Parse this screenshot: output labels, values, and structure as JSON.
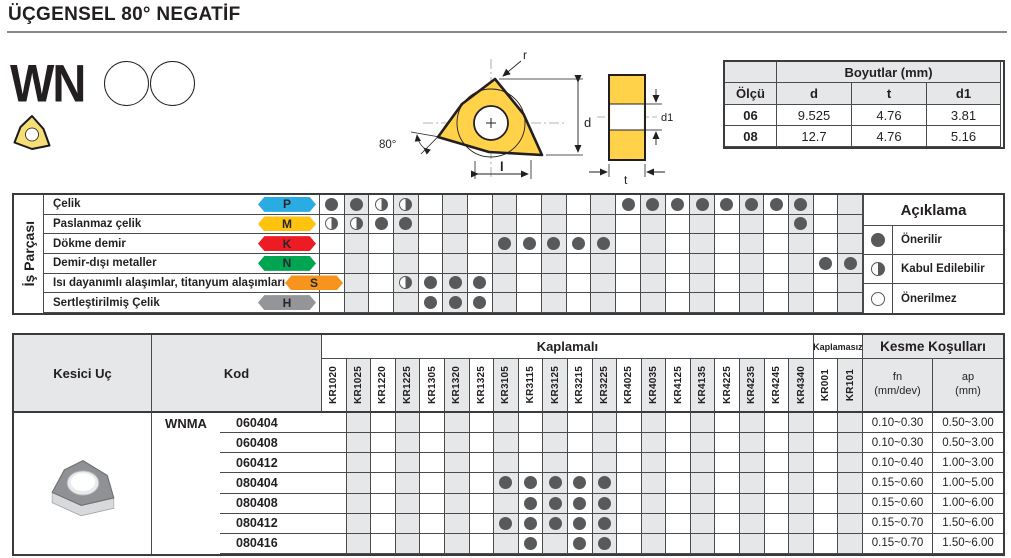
{
  "page": {
    "title": "ÜÇGENSEL 80° NEGATİF"
  },
  "product": {
    "code": "WN"
  },
  "drawing": {
    "r": "r",
    "angle": "80°",
    "d": "d",
    "l": "l",
    "t": "t",
    "d1": "d1"
  },
  "dimensions_table": {
    "title": "Boyutlar (mm)",
    "headers": {
      "size": "Ölçü",
      "d": "d",
      "t": "t",
      "d1": "d1"
    },
    "rows": [
      {
        "size": "06",
        "d": "9.525",
        "t": "4.76",
        "d1": "3.81"
      },
      {
        "size": "08",
        "d": "12.7",
        "t": "4.76",
        "d1": "5.16"
      }
    ]
  },
  "grades": [
    "KR1020",
    "KR1025",
    "KR1220",
    "KR1225",
    "KR1305",
    "KR1320",
    "KR1325",
    "KR3105",
    "KR3115",
    "KR3125",
    "KR3215",
    "KR3225",
    "KR4025",
    "KR4035",
    "KR4125",
    "KR4135",
    "KR4225",
    "KR4235",
    "KR4245",
    "KR4340",
    "KR001",
    "KR101"
  ],
  "material_table": {
    "side_label": "İş Parçası",
    "rows": [
      {
        "name": "Çelik",
        "iso": "P",
        "color": "#2aabe2",
        "marks": {
          "filled": [
            0,
            1,
            12,
            13,
            14,
            15,
            16,
            17,
            18,
            19
          ],
          "half": [
            2,
            3
          ]
        }
      },
      {
        "name": "Paslanmaz çelik",
        "iso": "M",
        "color": "#ffc20e",
        "marks": {
          "filled": [
            2,
            3,
            19
          ],
          "half": [
            0,
            1
          ]
        }
      },
      {
        "name": "Dökme demir",
        "iso": "K",
        "color": "#ed1c24",
        "marks": {
          "filled": [
            7,
            8,
            9,
            10,
            11
          ],
          "half": []
        }
      },
      {
        "name": "Demir-dışı metaller",
        "iso": "N",
        "color": "#00a551",
        "marks": {
          "filled": [
            20,
            21
          ],
          "half": []
        }
      },
      {
        "name": "Isı dayanımlı alaşımlar, titanyum alaşımları",
        "iso": "S",
        "color": "#f7941e",
        "marks": {
          "filled": [
            4,
            5,
            6
          ],
          "half": [
            3
          ]
        }
      },
      {
        "name": "Sertleştirilmiş Çelik",
        "iso": "H",
        "color": "#939598",
        "marks": {
          "filled": [
            4,
            5,
            6
          ],
          "half": []
        }
      }
    ],
    "legend": {
      "title": "Açıklama",
      "items": [
        {
          "symbol": "filled-circle",
          "label": "Önerilir"
        },
        {
          "symbol": "half-circle",
          "label": "Kabul Edilebilir"
        },
        {
          "symbol": "empty-circle",
          "label": "Önerilmez"
        }
      ]
    }
  },
  "main_table": {
    "headers": {
      "insert": "Kesici Uç",
      "code": "Kod",
      "coated": "Kaplamalı",
      "uncoated": "Kaplamasız",
      "cutting": "Kesme Koşulları",
      "fn_line1": "fn",
      "fn_line2": "(mm/dev)",
      "ap_line1": "ap",
      "ap_line2": "(mm)"
    },
    "series_prefix": "WNMA",
    "rows": [
      {
        "code": "060404",
        "dots": [],
        "fn": "0.10~0.30",
        "ap": "0.50~3.00"
      },
      {
        "code": "060408",
        "dots": [],
        "fn": "0.10~0.30",
        "ap": "0.50~3.00"
      },
      {
        "code": "060412",
        "dots": [],
        "fn": "0.10~0.40",
        "ap": "1.00~3.00"
      },
      {
        "code": "080404",
        "dots": [
          7,
          8,
          9,
          10,
          11
        ],
        "fn": "0.15~0.60",
        "ap": "1.00~5.00"
      },
      {
        "code": "080408",
        "dots": [
          8,
          9,
          10,
          11
        ],
        "fn": "0.15~0.60",
        "ap": "1.00~6.00"
      },
      {
        "code": "080412",
        "dots": [
          7,
          8,
          9,
          10,
          11
        ],
        "fn": "0.15~0.70",
        "ap": "1.50~6.00"
      },
      {
        "code": "080416",
        "dots": [
          8,
          10,
          11
        ],
        "fn": "0.15~0.70",
        "ap": "1.50~6.00"
      }
    ]
  },
  "colors": {
    "insert_yellow": "#FFD24A",
    "icon_yellow": "#F6DE76",
    "dot_gray": "#58595b",
    "shade_gray": "#e6e7e8"
  }
}
